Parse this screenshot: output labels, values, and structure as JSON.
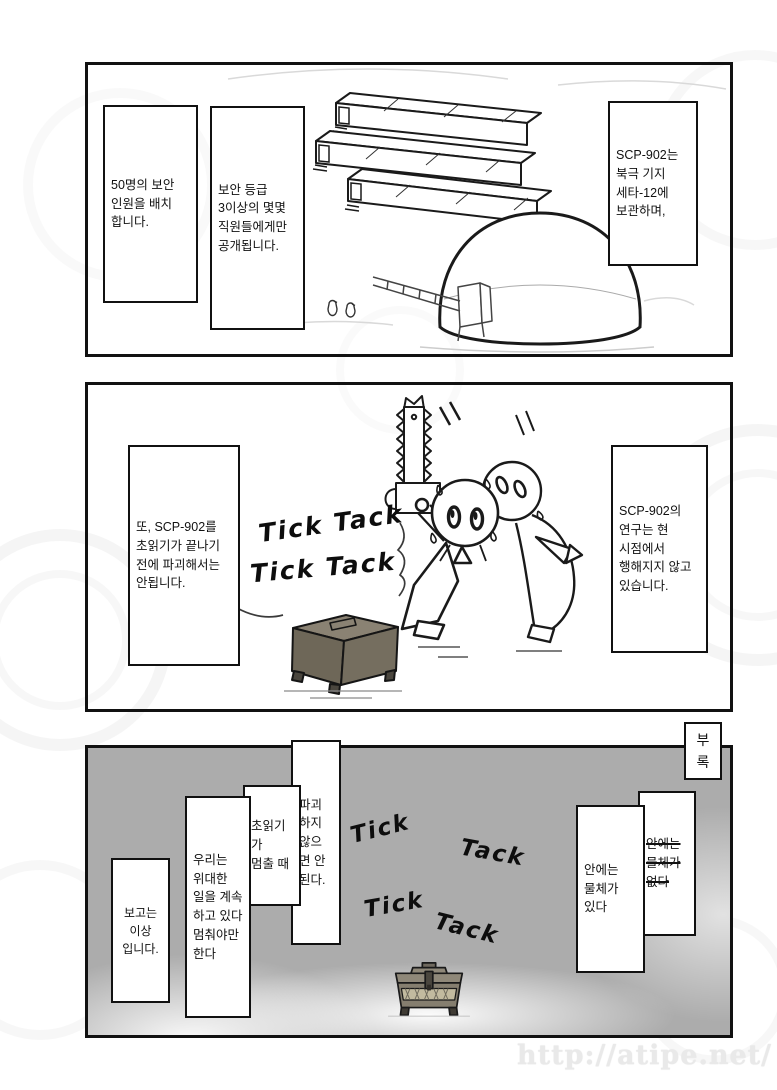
{
  "page": {
    "watermark_url_text": "http://atipe.net/"
  },
  "panel_top": {
    "caption_personnel": "50명의 보안\n인원을 배치\n합니다.",
    "caption_clearance": "보안 등급\n3이상의 몇몇\n직원들에게만\n공개됩니다.",
    "caption_storage": "SCP-902는\n북극 기지\n세타-12에\n보관하며,"
  },
  "panel_middle": {
    "caption_destruction_rule": "또, SCP-902를\n초읽기가 끝나기\n전에 파괴해서는\n안됩니다.",
    "caption_research_status": "SCP-902의\n연구는 현\n시점에서\n행해지지 않고\n있습니다.",
    "sfx": [
      "Tick Tack",
      "Tick Tack"
    ]
  },
  "panel_bottom": {
    "appendix_tab": "부록",
    "caption_report_end": "보고는\n이상\n입니다.",
    "caption_great_work": "우리는\n위대한\n일을 계속\n하고 있다\n멈춰야만\n한다",
    "caption_countdown": "초읽기가\n멈출 때",
    "caption_must_destroy": "파괴\n하지\n않으\n면 안\n된다.",
    "caption_object_inside": "안에는\n물체가\n있다",
    "caption_object_missing": "안에는\n물체가\n없다",
    "sfx": [
      "Tick",
      "Tack",
      "Tick",
      "Tack"
    ]
  }
}
